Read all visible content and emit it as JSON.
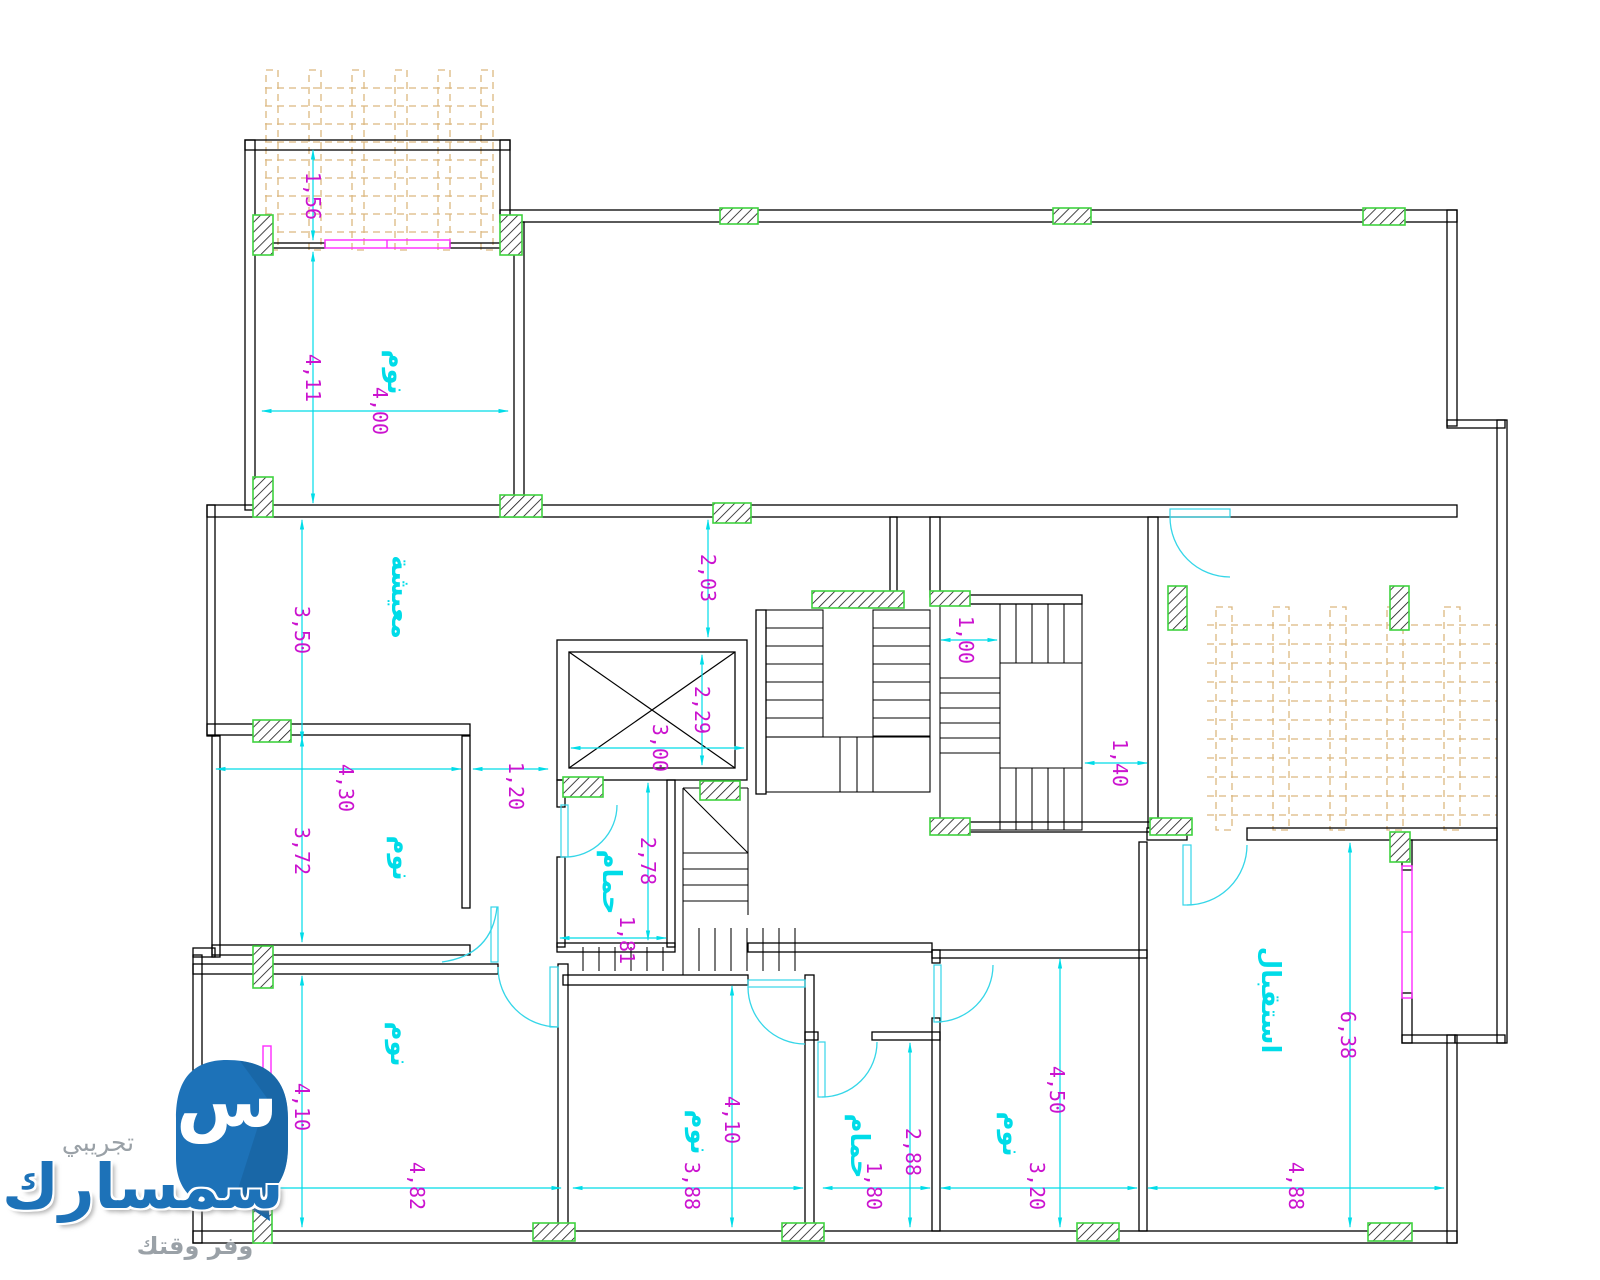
{
  "watermark": {
    "trial": "تجريبي",
    "brand": "سمسارك",
    "tagline": "وفر وقتك",
    "monogram": "س"
  },
  "colors": {
    "wall": "#000000",
    "column_border": "#3fd23f",
    "pergola": "#dcb87f",
    "dimension_text": "#cb13cf",
    "annotation_cyan": "#00dce8",
    "window": "#ff2bff",
    "logo_blue": "#1d72b8",
    "logo_gray": "#9aa1a7"
  },
  "rooms": [
    {
      "label": "نوم",
      "x": 397,
      "y": 372
    },
    {
      "label": "معيشة",
      "x": 401,
      "y": 597
    },
    {
      "label": "نوم",
      "x": 402,
      "y": 858
    },
    {
      "label": "حمام",
      "x": 612,
      "y": 882
    },
    {
      "label": "نوم",
      "x": 400,
      "y": 1044
    },
    {
      "label": "نوم",
      "x": 700,
      "y": 1132
    },
    {
      "label": "حمام",
      "x": 860,
      "y": 1146
    },
    {
      "label": "نوم",
      "x": 1012,
      "y": 1134
    },
    {
      "label": "استقبال",
      "x": 1271,
      "y": 1000
    }
  ],
  "dimensions": [
    {
      "value": "1,56",
      "x": 313,
      "y": 196
    },
    {
      "value": "4,11",
      "x": 313,
      "y": 378
    },
    {
      "value": "4,00",
      "x": 380,
      "y": 411
    },
    {
      "value": "3,50",
      "x": 302,
      "y": 630
    },
    {
      "value": "2,03",
      "x": 708,
      "y": 578
    },
    {
      "value": "2,29",
      "x": 702,
      "y": 710
    },
    {
      "value": "3,00",
      "x": 660,
      "y": 748
    },
    {
      "value": "1,00",
      "x": 966,
      "y": 640
    },
    {
      "value": "1,40",
      "x": 1120,
      "y": 763
    },
    {
      "value": "1,20",
      "x": 516,
      "y": 786
    },
    {
      "value": "4,30",
      "x": 346,
      "y": 788
    },
    {
      "value": "3,72",
      "x": 302,
      "y": 851
    },
    {
      "value": "2,78",
      "x": 648,
      "y": 861
    },
    {
      "value": "1,81",
      "x": 627,
      "y": 940
    },
    {
      "value": "4,10",
      "x": 302,
      "y": 1107
    },
    {
      "value": "4,82",
      "x": 417,
      "y": 1186
    },
    {
      "value": "4,10",
      "x": 732,
      "y": 1120
    },
    {
      "value": "3,88",
      "x": 692,
      "y": 1186
    },
    {
      "value": "2,88",
      "x": 913,
      "y": 1152
    },
    {
      "value": "1,80",
      "x": 874,
      "y": 1186
    },
    {
      "value": "4,50",
      "x": 1057,
      "y": 1090
    },
    {
      "value": "3,20",
      "x": 1037,
      "y": 1186
    },
    {
      "value": "6,38",
      "x": 1348,
      "y": 1035
    },
    {
      "value": "4,88",
      "x": 1296,
      "y": 1186
    }
  ]
}
